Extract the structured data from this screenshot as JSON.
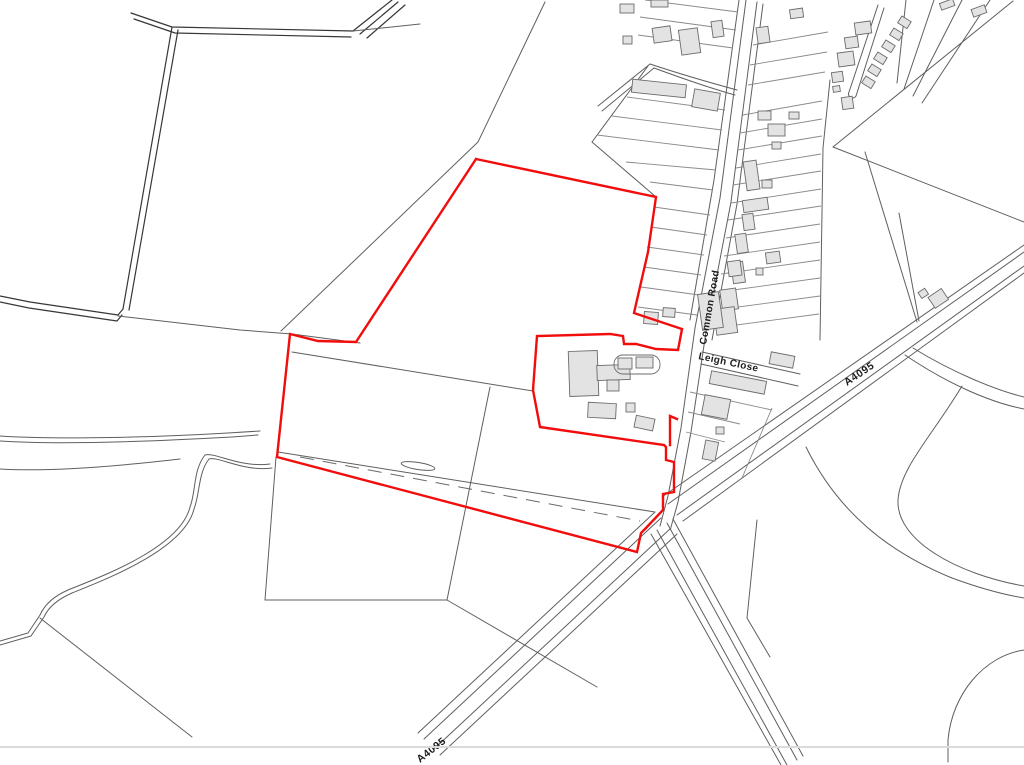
{
  "map": {
    "type": "site-location-plan",
    "colors": {
      "site_boundary": "#f20d0d",
      "road_line": "#5f5f5f",
      "field_line": "#373737",
      "building_fill": "#e3e3e3",
      "building_stroke": "#6b6b6b",
      "map_edge": "#dadada",
      "background": "#ffffff"
    },
    "labels": [
      {
        "id": "common-road",
        "text": "Common Road",
        "transform": "translate(706,345) rotate(-80)"
      },
      {
        "id": "leigh-close",
        "text": "Leigh Close",
        "transform": "translate(698,359) rotate(12)"
      },
      {
        "id": "a4095-upper",
        "text": "A4095",
        "transform": "translate(847,386) rotate(-34)"
      },
      {
        "id": "a4095-lower",
        "text": "A4095",
        "transform": "translate(420,763) rotate(-38)"
      }
    ],
    "site_boundary": {
      "main_points": "476,159 656,197 648,252 634,313 682,329 678,350 656,349 636,344 624,344 623,336 610,334 537,336 533,390 540,427 664,445 666,447 666,460 674,462 674,492 663,494 663,510 645,529 641,533 637,552 277,457 290,334 318,341 356,342 476,159",
      "spur_points": "670,445 670,416 677,419"
    }
  }
}
